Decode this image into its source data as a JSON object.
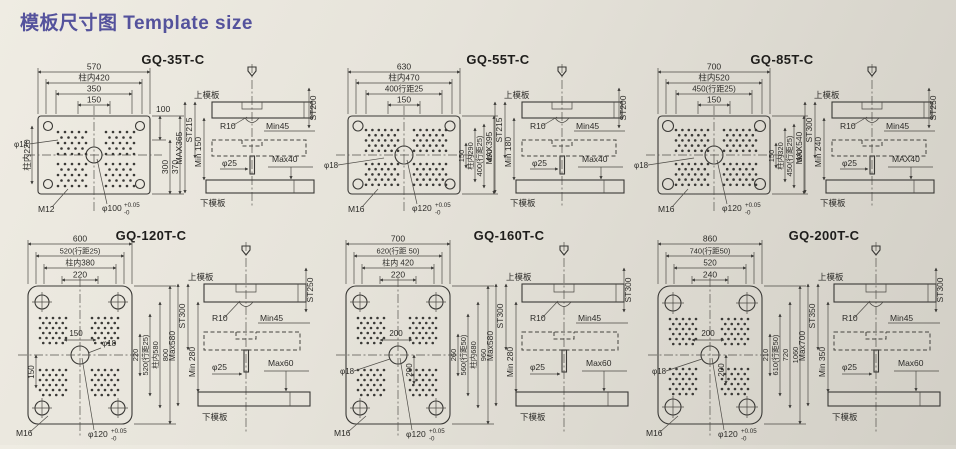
{
  "title": "模板尺寸图 Template size",
  "d": [
    {
      "model": "GQ-35T-C",
      "f": {
        "dims": [
          "570",
          "柱内420",
          "350",
          "150"
        ],
        "r": [
          "100",
          "300",
          "370"
        ],
        "l": "柱内220",
        "hole": "φ14",
        "screw": "M12",
        "center": "φ100",
        "tp": "+0.05",
        "tm": "-0"
      },
      "s": {
        "up": "上模板",
        "low": "下模板",
        "st": "ST200",
        "r10": "R10",
        "min": "Min45",
        "max": "Max40",
        "lo": "MAX365",
        "lst": "ST215",
        "lmin": "Min 150",
        "pin": "φ25"
      }
    },
    {
      "model": "GQ-55T-C",
      "f": {
        "dims": [
          "630",
          "柱内470",
          "400行距25",
          "150"
        ],
        "r": [
          "150",
          "柱内290",
          "400(行距25)",
          "450"
        ],
        "hole": "φ18",
        "screw": "M16",
        "center": "φ120",
        "tp": "+0.05",
        "tm": "-0"
      },
      "s": {
        "up": "上模板",
        "low": "下模板",
        "st": "ST200",
        "r10": "R10",
        "min": "Min45",
        "max": "Max40",
        "lo": "MAX395",
        "lst": "ST215",
        "lmin": "Min 180",
        "pin": "φ25"
      }
    },
    {
      "model": "GQ-85T-C",
      "f": {
        "dims": [
          "700",
          "柱内520",
          "450(行距25)",
          "150"
        ],
        "r": [
          "150",
          "柱内320",
          "450(行距25)",
          "500"
        ],
        "hole": "φ18",
        "screw": "M16",
        "center": "φ120",
        "tp": "+0.05",
        "tm": "-0"
      },
      "s": {
        "up": "上模板",
        "low": "下模板",
        "st": "ST250",
        "r10": "R10",
        "min": "Min45",
        "max": "MAX40",
        "lo": "MAX540",
        "lst": "ST300",
        "lmin": "Min 240",
        "pin": "φ25"
      }
    },
    {
      "model": "GQ-120T-C",
      "f": {
        "dims": [
          "600",
          "520(行距25)",
          "柱内380",
          "220"
        ],
        "r": [
          "220",
          "520(行距25)",
          "柱内580",
          "800"
        ],
        "mid": "150",
        "vert": "150",
        "hole": "φ18",
        "screw": "M16",
        "center": "φ120",
        "tp": "+0.05",
        "tm": "-0"
      },
      "s": {
        "up": "上模板",
        "low": "下模板",
        "st": "ST250",
        "r10": "R10",
        "min": "Min45",
        "max": "Max60",
        "lo": "Max580",
        "lst": "ST300",
        "lmin": "Min 280",
        "pin": "φ25"
      }
    },
    {
      "model": "GQ-160T-C",
      "f": {
        "dims": [
          "700",
          "620(行距 50)",
          "柱内 420",
          "220"
        ],
        "r": [
          "260",
          "560(行距50)",
          "柱内680",
          "960"
        ],
        "mid": "200",
        "vert": "200",
        "hole": "φ18",
        "screw": "M16",
        "center": "φ120",
        "tp": "+0.05",
        "tm": "-0"
      },
      "s": {
        "up": "上模板",
        "low": "下模板",
        "st": "ST300",
        "r10": "R10",
        "min": "Min45",
        "max": "Max60",
        "lo": "Max580",
        "lst": "ST300",
        "lmin": "Min 280",
        "pin": "φ25"
      }
    },
    {
      "model": "GQ-200T-C",
      "f": {
        "dims": [
          "860",
          "740(行距50)",
          "520",
          "240"
        ],
        "r": [
          "210",
          "610(行距50)",
          "720",
          "1060"
        ],
        "mid": "200",
        "vert": "200",
        "hole": "φ18",
        "screw": "M16",
        "center": "φ120",
        "tp": "+0.05",
        "tm": "-0"
      },
      "s": {
        "up": "上模板",
        "low": "下模板",
        "st": "ST300",
        "r10": "R10",
        "min": "Min45",
        "max": "Max60",
        "lo": "Max700",
        "lst": "ST350",
        "lmin": "Min 350",
        "pin": "φ25"
      }
    }
  ]
}
